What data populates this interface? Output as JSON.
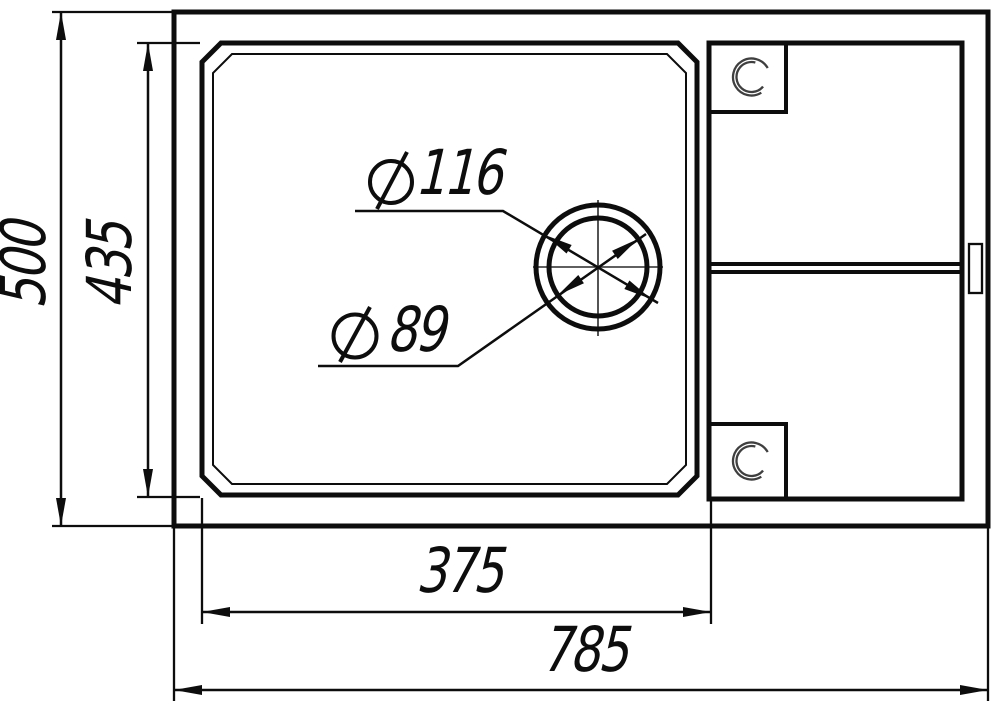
{
  "drawing": {
    "dimensions": {
      "overall_height": {
        "value": "500"
      },
      "bowl_height": {
        "value": "435"
      },
      "drain_outer": {
        "symbol": "diameter",
        "value": "116"
      },
      "drain_inner": {
        "symbol": "diameter",
        "value": "89"
      },
      "bowl_width": {
        "value": "375"
      },
      "overall_width": {
        "value": "785"
      }
    },
    "icons": {
      "diameter_symbol": "Ø"
    },
    "colors": {
      "line": "#0d0d0d",
      "centerline": "#2a2a2a",
      "sketch_circle": "#3f3f3f",
      "background": "#ffffff"
    }
  }
}
